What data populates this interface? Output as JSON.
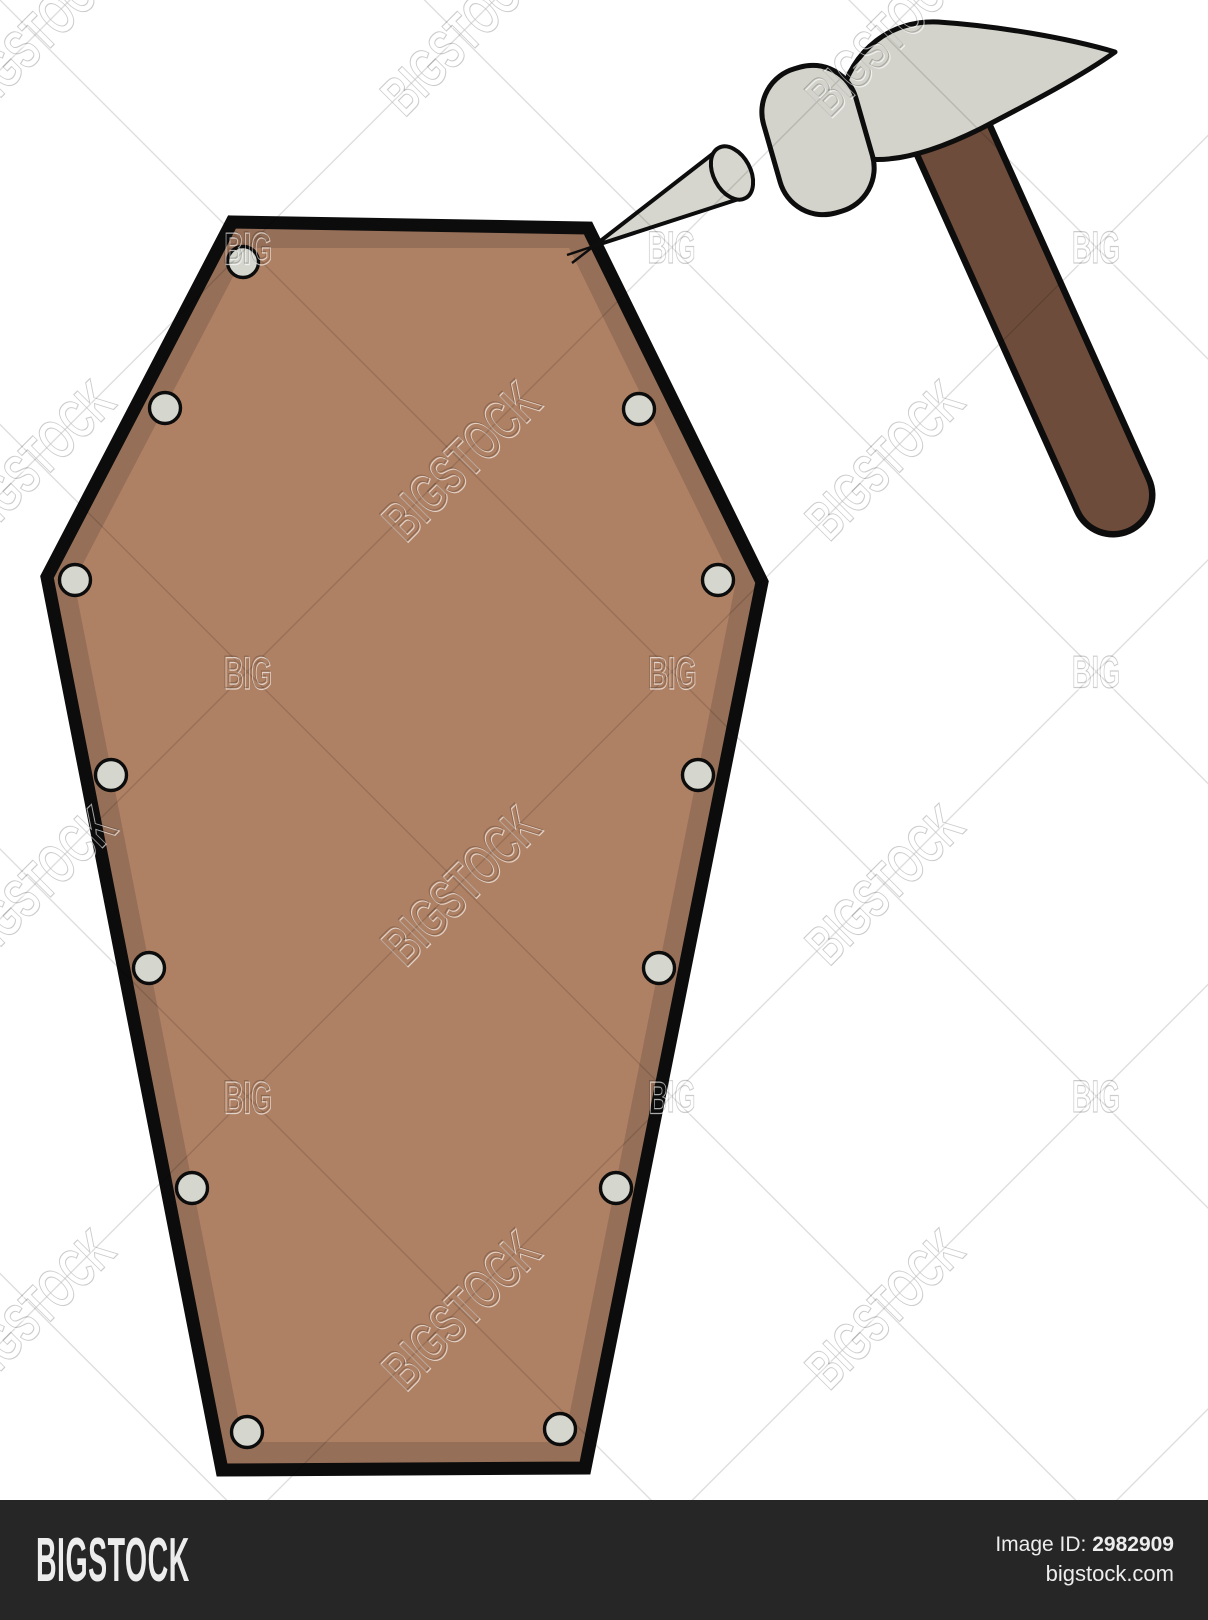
{
  "page": {
    "background": "#ffffff",
    "art_height": 1500,
    "footer_height": 120
  },
  "footer": {
    "logo": "BIGSTOCK",
    "image_id_label": "Image ID:",
    "image_id": "2982909",
    "site": "bigstock.com",
    "background": "#262626",
    "text_color": "#ededed"
  },
  "watermark": {
    "diagonal_text": "BIGSTOCK",
    "corner_text": "BIG",
    "origin": 35,
    "step": 424.5,
    "corner_offset": 212,
    "count": 4,
    "diag_font": 56,
    "diag_length": 195,
    "corner_font": 45,
    "corner_length": 48,
    "ink": "rgba(0,0,0,0.20)",
    "highlight": "rgba(255,255,255,0.65)",
    "line_color": "rgba(0,0,0,0.13)",
    "line_width": 1.4
  },
  "illustration": {
    "coffin": {
      "outer_points": [
        [
          232,
          222
        ],
        [
          588,
          228
        ],
        [
          762,
          582
        ],
        [
          585,
          1468
        ],
        [
          222,
          1470
        ],
        [
          47,
          577
        ]
      ],
      "inner_points": [
        [
          248,
          248
        ],
        [
          569,
          248
        ],
        [
          735,
          586
        ],
        [
          564,
          1442
        ],
        [
          243,
          1442
        ],
        [
          74,
          581
        ]
      ],
      "fill": "#af8164",
      "bevel_fill": "#966f58",
      "outline_color": "#0c0c0c",
      "outline_width": 13,
      "tack_radius": 15.5,
      "tack_fill": "#d5d6ce",
      "tack_outline": 3.4,
      "tacks": [
        [
          243,
          262
        ],
        [
          165,
          408
        ],
        [
          75,
          580
        ],
        [
          111,
          775
        ],
        [
          149,
          968
        ],
        [
          192,
          1188
        ],
        [
          247,
          1432
        ],
        [
          560,
          1429
        ],
        [
          616,
          1188
        ],
        [
          659,
          968
        ],
        [
          698,
          775
        ],
        [
          718,
          580
        ],
        [
          639,
          409
        ]
      ]
    },
    "hammer": {
      "metal_fill": "#d3d3cb",
      "outline_color": "#0d0d0d",
      "outline_width": 5,
      "handle": {
        "x1": 939,
        "y1": 108,
        "x2": 1113,
        "y2": 495,
        "width": 72,
        "outline_extra": 13,
        "fill": "#6e4c3b"
      },
      "head": {
        "cx": 818,
        "cy": 140,
        "w": 96,
        "h": 150,
        "rx": 45,
        "rotate": -16
      },
      "claw_path": "M 840,100 C 852,48 892,20 938,22 C 998,26 1068,38 1115,52 C 1082,76 1028,104 982,128 C 938,150 898,162 868,159 C 847,156 837,128 840,100 Z"
    },
    "spike": {
      "fill": "#d6d6ce",
      "outline_color": "#0d0d0d",
      "outline_width": 4,
      "tip": [
        594,
        246
      ],
      "base_a": [
        719,
        149
      ],
      "base_b": [
        745,
        197
      ],
      "tip_tails": [
        [
          572,
          263
        ],
        [
          567,
          255
        ]
      ],
      "head": {
        "cx": 732,
        "cy": 173,
        "rx": 18.5,
        "ry": 28.5,
        "rotate": -28
      }
    }
  }
}
